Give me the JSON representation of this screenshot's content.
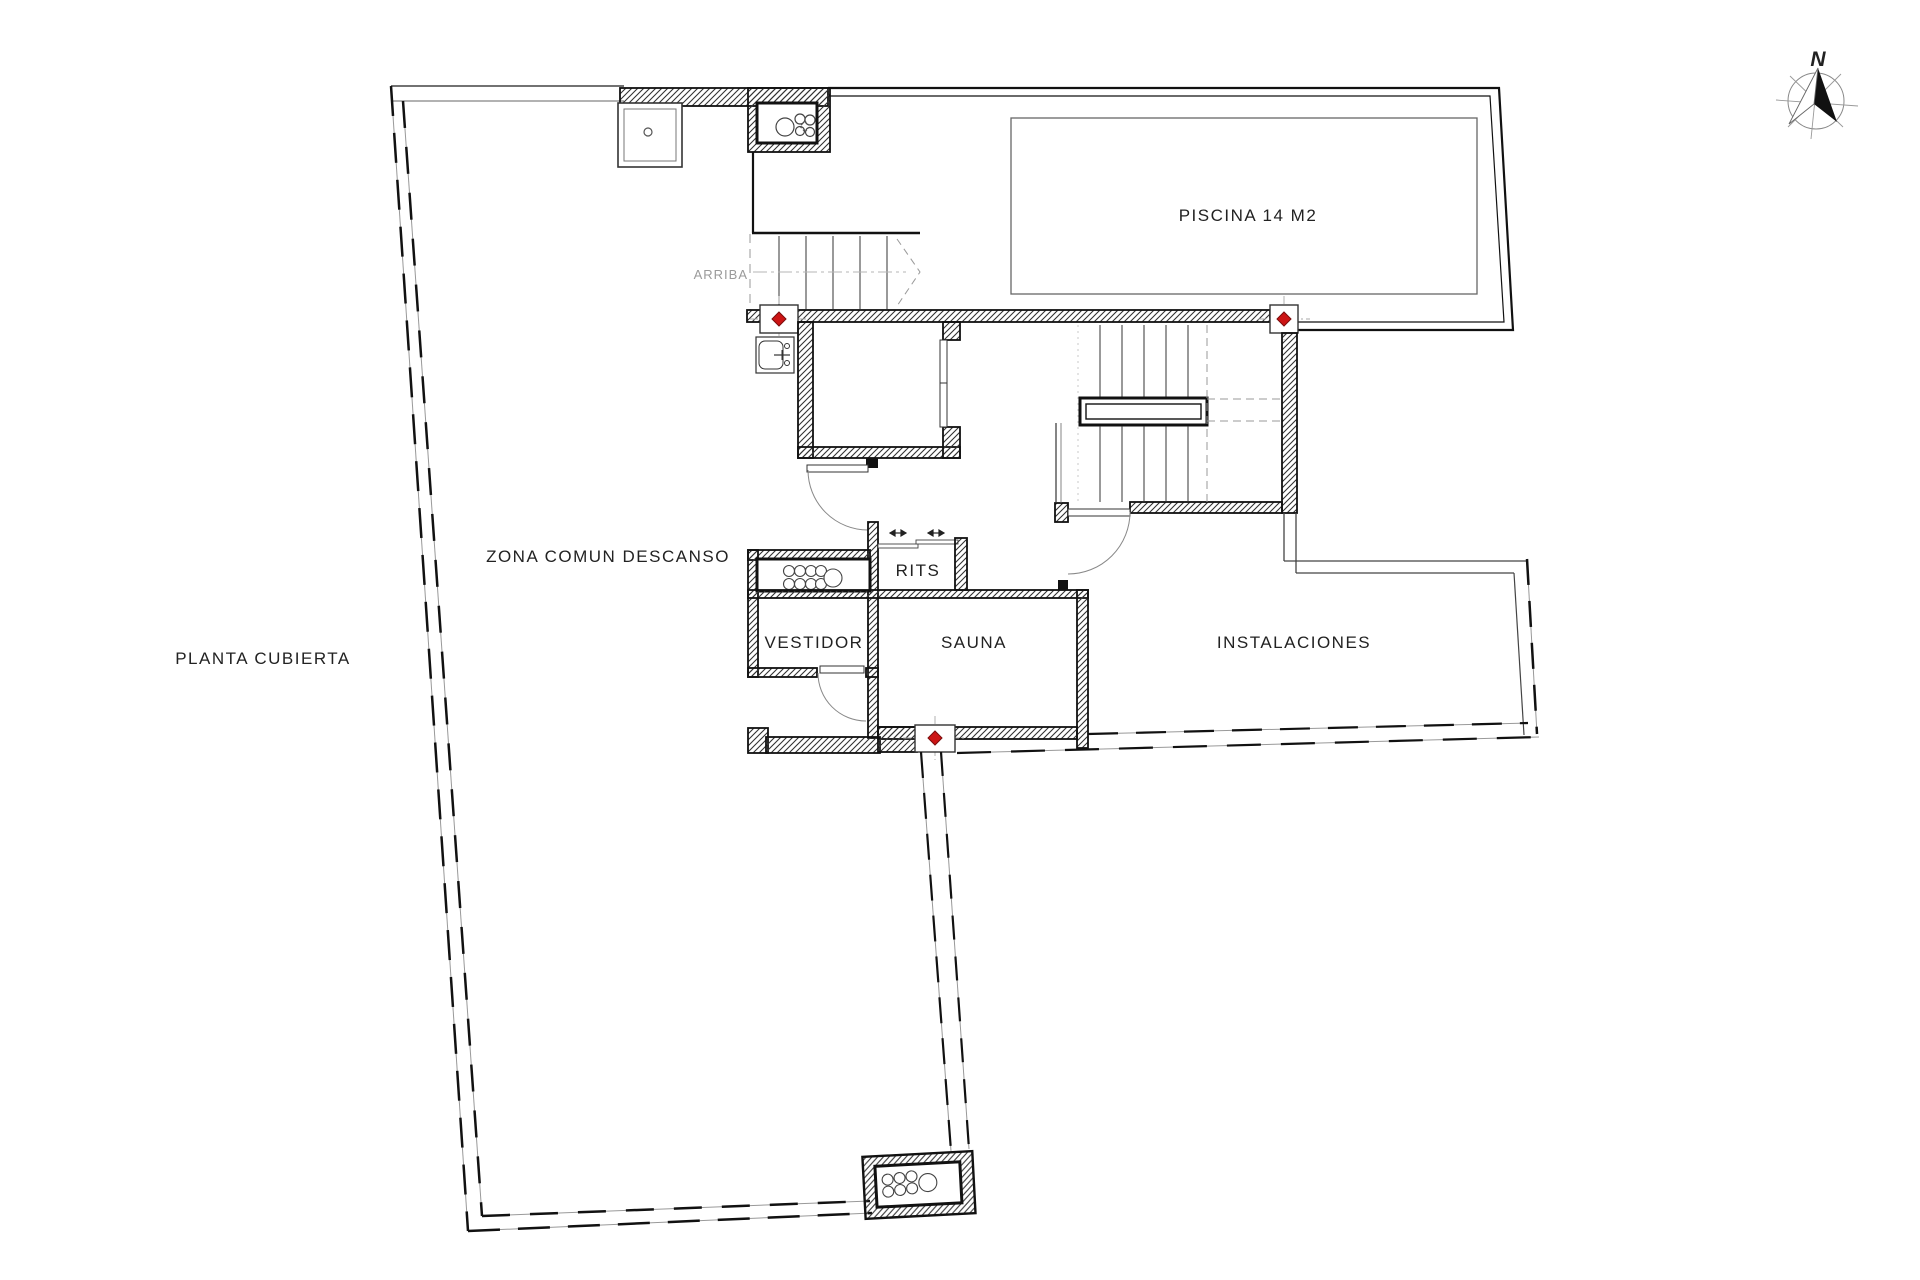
{
  "plan": {
    "floor_label": "PLANTA CUBIERTA",
    "rooms": {
      "zona_comun": "ZONA COMUN DESCANSO",
      "piscina": "PISCINA 14 M2",
      "rits": "RITS",
      "vestidor": "VESTIDOR",
      "sauna": "SAUNA",
      "instalaciones": "INSTALACIONES"
    },
    "stair_label": "ARRIBA",
    "compass_label": "N",
    "colors": {
      "marker_red": "#cc1414",
      "marker_red_edge": "#7a0c0c",
      "wall_line": "#111111",
      "thin_line": "#555555",
      "faint_line": "#999999",
      "background": "#ffffff"
    }
  }
}
